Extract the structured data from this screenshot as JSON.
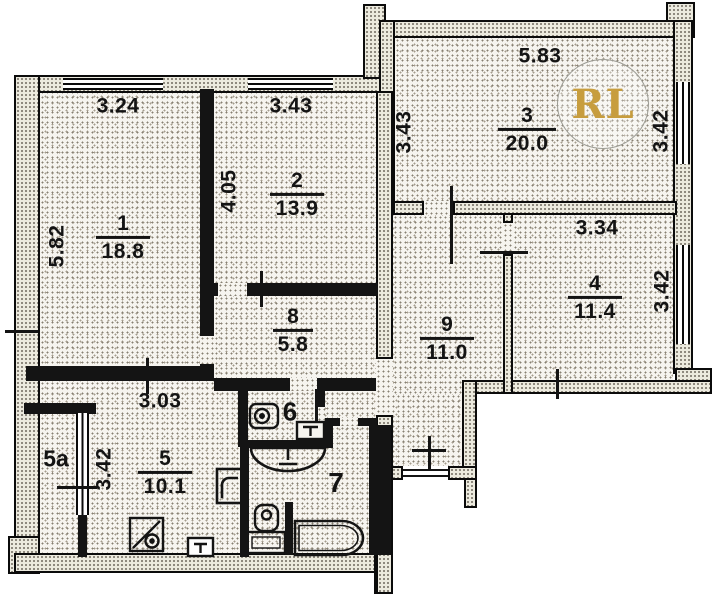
{
  "plan": {
    "watermark": "RL",
    "rooms": {
      "r1": {
        "number": "1",
        "area": "18.8"
      },
      "r2": {
        "number": "2",
        "area": "13.9"
      },
      "r3": {
        "number": "3",
        "area": "20.0"
      },
      "r4": {
        "number": "4",
        "area": "11.4"
      },
      "r5": {
        "number": "5",
        "area": "10.1"
      },
      "r5a": {
        "number": "5a"
      },
      "r6": {
        "number": "6"
      },
      "r7": {
        "number": "7"
      },
      "r8": {
        "number": "8",
        "area": "5.8"
      },
      "r9": {
        "number": "9",
        "area": "11.0"
      }
    },
    "dimensions": {
      "room1_top": "3.24",
      "room2_top": "3.43",
      "room3_top": "5.83",
      "room1_left": "5.82",
      "room2_left": "4.05",
      "room3_left": "3.43",
      "room3_right": "3.42",
      "room4_top": "3.34",
      "room4_right": "3.42",
      "hall_width": "3.03",
      "hall_left": "3.42"
    }
  }
}
